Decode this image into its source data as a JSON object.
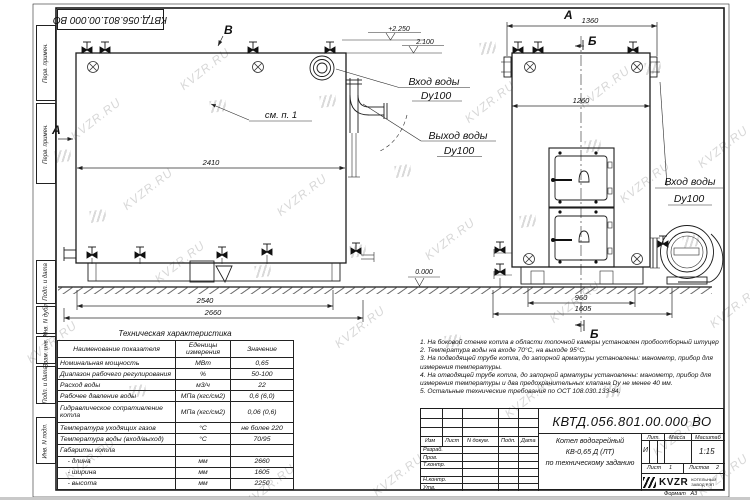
{
  "watermark": {
    "text": "KVZR.RU"
  },
  "stamp_top": {
    "doc_number": "КВТД.056.801.00.000  ВО"
  },
  "side_strip": {
    "labels": [
      "Перв. примен.",
      "Перв. примен.",
      "Подп. и дата",
      "Инв. N дубл.",
      "Взам. инв. N",
      "Подп. и дата",
      "Инв. N подл."
    ]
  },
  "views": {
    "side": {
      "view_arrow_a": "А",
      "view_arrow_v": "В",
      "detail_ref": "см. п. 1",
      "dim_length": "2410",
      "dim_base": "2540",
      "dim_overall": "2660",
      "level_top": "+2.250",
      "level_mid": "2.100",
      "level_ground": "0.000",
      "callout_inlet_line1": "Вход воды",
      "callout_inlet_line2": "Dy100",
      "callout_outlet_line1": "Выход воды",
      "callout_outlet_line2": "Dy100"
    },
    "front": {
      "view_label": "А",
      "section_label": "Б",
      "dim_top": "1360",
      "dim_inner": "1260",
      "dim_base": "960",
      "dim_overall": "1605",
      "callout_inlet_line1": "Вход воды",
      "callout_inlet_line2": "Dy100"
    }
  },
  "tech_table": {
    "title": "Техническая характеристика",
    "headers": [
      "Наименование показателя",
      "Еденицы измерения",
      "Значение"
    ],
    "rows": [
      [
        "Номинальная мощность",
        "МВт",
        "0,65"
      ],
      [
        "Диапазон рабочего регулирования",
        "%",
        "50-100"
      ],
      [
        "Расход воды",
        "м3/ч",
        "22"
      ],
      [
        "Рабочее давление воды",
        "МПа (кгс/см2)",
        "0,6 (6,0)"
      ],
      [
        "Гидравлическое сопративление котла",
        "МПа (кгс/см2)",
        "0,06 (0,6)"
      ],
      [
        "Температура уходящих газов",
        "°С",
        "не более 220"
      ],
      [
        "Температура воды (вход/выход)",
        "°С",
        "70/95"
      ],
      [
        "Габариты котла",
        "",
        ""
      ],
      [
        "    - длина",
        "мм",
        "2660"
      ],
      [
        "    - ширина",
        "мм",
        "1605"
      ],
      [
        "    - высота",
        "мм",
        "2250"
      ]
    ]
  },
  "notes": {
    "items": [
      "1.  На боковой стенке котла в области топочной камеры установлен пробоотборный штуцер",
      "2.  Температура воды на входе  70°С,  на выходе  95°С.",
      "3.  На подводящей трубе котла, до запорной арматуры установлены:  манометр,  прибор для измерения температуры.",
      "4.  На отводящей трубе котла, до запорной арматуры установлены:  манометр,  прибор для измерения температуры и два предохранительных клапана  Dу не менее  40 мм.",
      "5.  Остальные технические требования по ОСТ  108.030.133-84."
    ]
  },
  "title_block": {
    "doc_number": "КВТД.056.801.00.000  ВО",
    "name_line1": "Котел водогрейный",
    "name_line2": "КВ-0,65 Д (ЛТ)",
    "name_line3": "по техническому заданию",
    "col_izm": "Изм",
    "col_list": "Лист",
    "col_doc": "N докум.",
    "col_podp": "Подп.",
    "col_data": "Дата",
    "row_razrab": "Разраб.",
    "row_prov": "Пров.",
    "row_tkontr": "Т.контр.",
    "row_nkontr": "Н.контр.",
    "row_utv": "Утв.",
    "lit_label": "Лит.",
    "lit_value": "И",
    "massa_label": "Масса",
    "masshtab_label": "Масштаб",
    "masshtab_value": "1:15",
    "sheet_label": "Лист",
    "sheet_value": "1",
    "sheets_label": "Листов",
    "sheets_value": "2",
    "logo_text": "KVZR",
    "logo_sub1": "КОТЕЛЬНЫЙ",
    "logo_sub2": "ЗАВОД РЭП",
    "format_label": "Формат",
    "format_value": "А3"
  }
}
